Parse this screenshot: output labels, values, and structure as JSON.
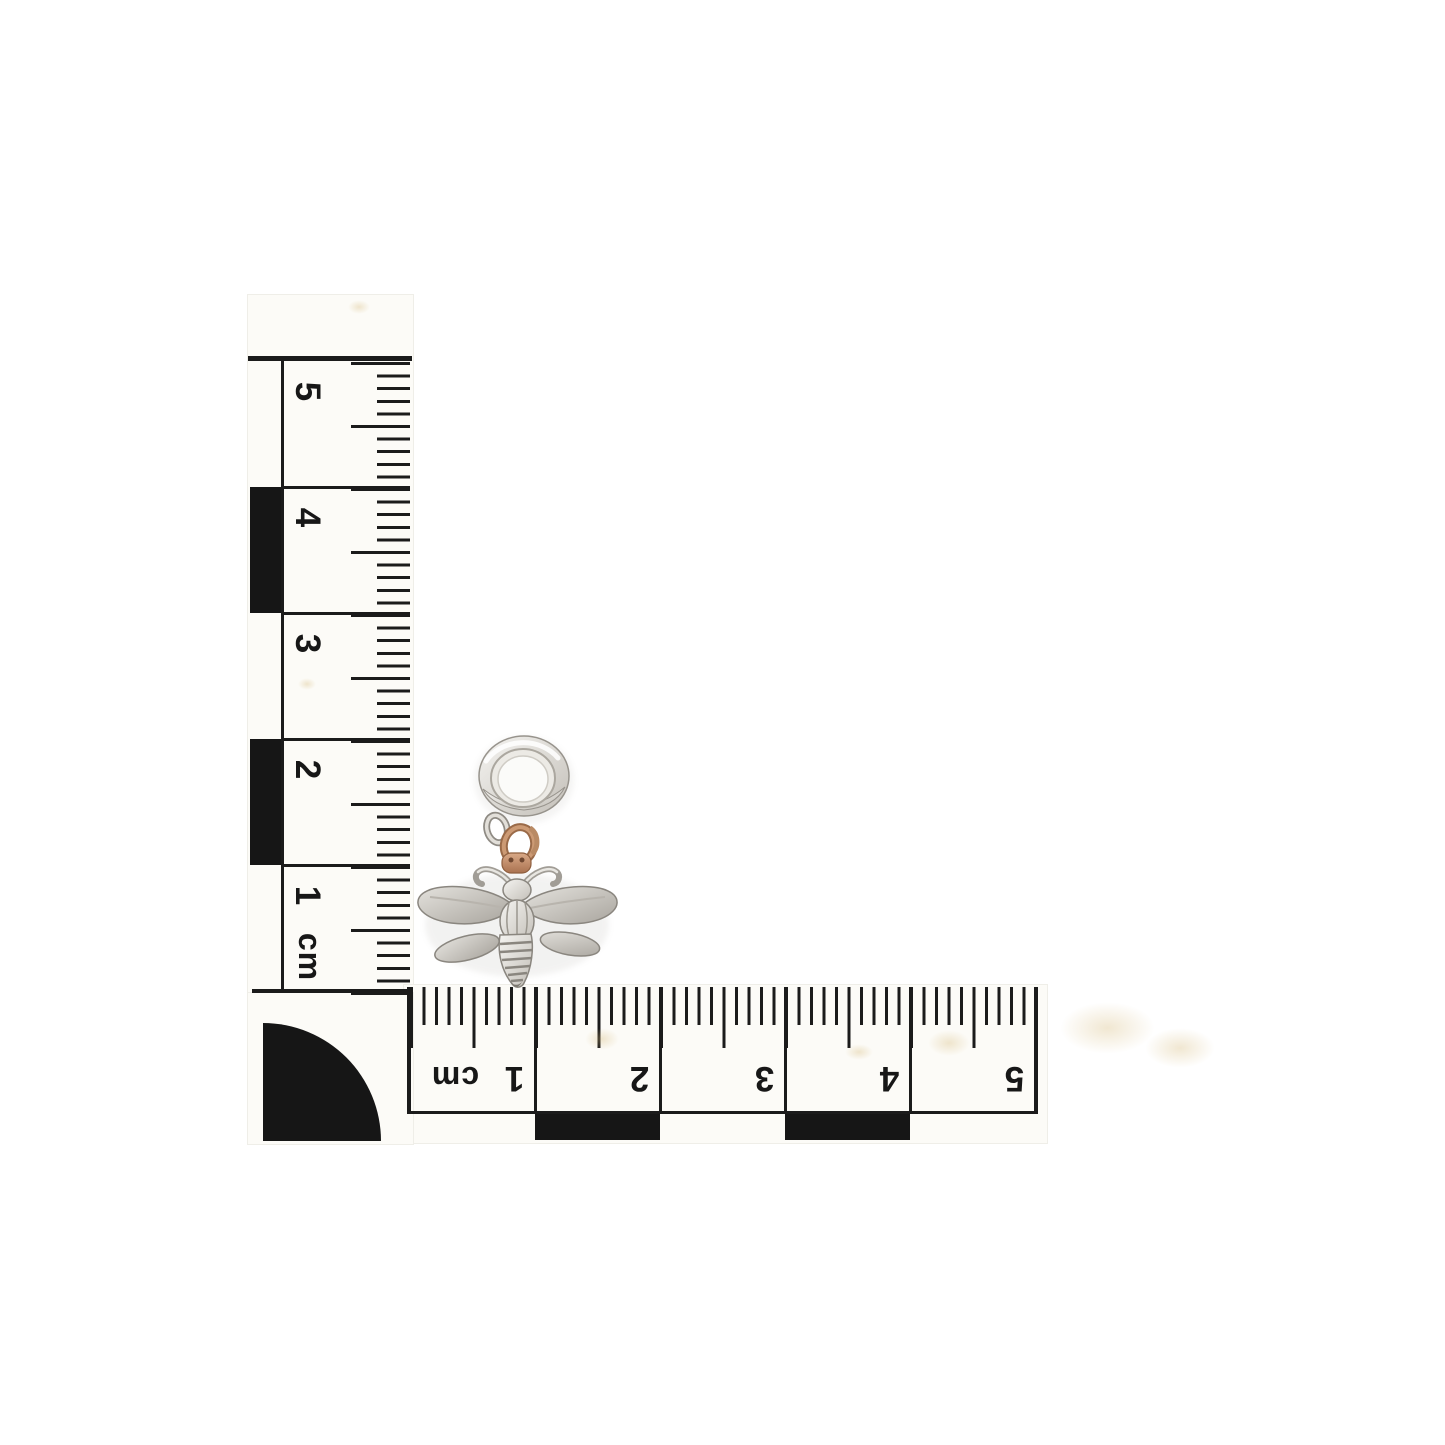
{
  "scene": {
    "type": "product-photo",
    "subject": "Silver bee charm with rose gold jump ring on a round silver bail, photographed beside an L-shaped centimetre photographic scale",
    "background_color": "#ffffff"
  },
  "scale_ruler": {
    "unit": "cm",
    "ink_color": "#1b1b1b",
    "paper_color": "#fcfbf7",
    "corner_marker": "quarter-circle",
    "vertical_labels": [
      "5",
      "4",
      "3",
      "2",
      "1",
      "cm"
    ],
    "horizontal_labels": [
      "cm",
      "1",
      "2",
      "3",
      "4",
      "5"
    ]
  },
  "charm": {
    "parts": {
      "bail": "round silver bail",
      "link": "silver link",
      "jump_ring": "rose gold jump ring",
      "pendant": "silver bee"
    },
    "silver_color": "#d8d5cf",
    "rose_gold_color": "#c08a66"
  }
}
